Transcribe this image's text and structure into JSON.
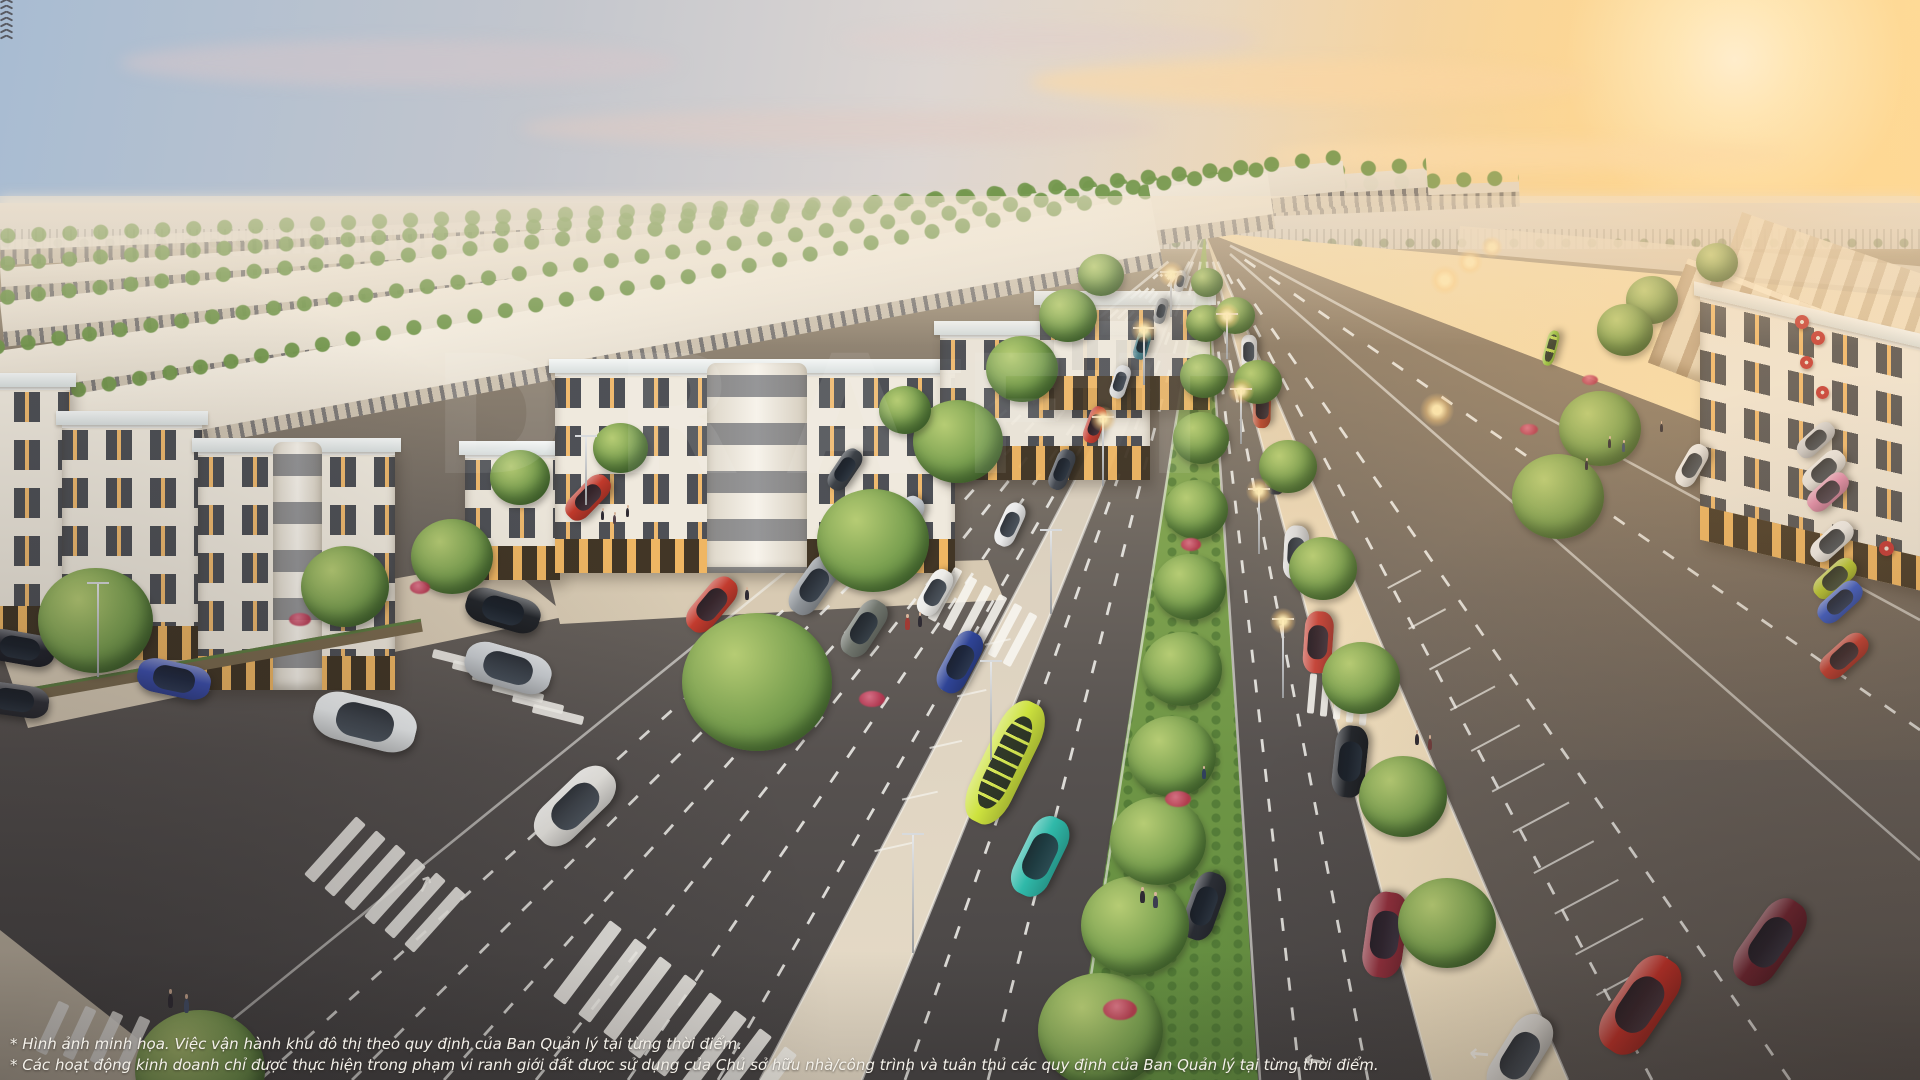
{
  "disclaimer": {
    "line1": "* Hình ảnh minh họa. Việc vận hành khu đô thị theo quy định của Ban Quản lý tại từng thời điểm.",
    "line2": "* Các hoạt động kinh doanh chỉ được thực hiện trong phạm vi ranh giới đất được sử dụng của Chủ sở hữu nhà/công trình và tuân thủ các quy định của Ban Quản lý tại từng thời điểm."
  },
  "watermark": {
    "text": "DRAFT"
  },
  "palette": {
    "sky_cool": "#a8bcd2",
    "sky_warm": "#ffe2a6",
    "sun_core": "#fff8e2",
    "asphalt_dark": "#464343",
    "asphalt_light": "#b3a184",
    "median_grass": "#6f9646",
    "walkway_sand": "#ecd9b8",
    "building_wall": "#efe9dd",
    "roof_slab": "#f2f3f1",
    "window_dark": "#2b2f38",
    "window_lit": "#f0b25c",
    "bus_yellow": "#cde23e",
    "flower_red": "#b8334e",
    "umbrella_red": "#c23434"
  },
  "scene": {
    "vehicles": [
      [
        365,
        722,
        104,
        14,
        "#eceff0",
        "suv"
      ],
      [
        508,
        668,
        88,
        16,
        "#c9cdd1",
        "car"
      ],
      [
        503,
        610,
        76,
        16,
        "#23262b",
        "suv"
      ],
      [
        575,
        806,
        96,
        -44,
        "#e9e7e2",
        "car"
      ],
      [
        174,
        679,
        74,
        12,
        "#3c4fae",
        "car"
      ],
      [
        20,
        648,
        70,
        10,
        "#23252e",
        "car"
      ],
      [
        14,
        700,
        70,
        8,
        "#303138",
        "car"
      ],
      [
        712,
        605,
        64,
        -50,
        "#c23b2e",
        "car"
      ],
      [
        588,
        497,
        54,
        -46,
        "#c0392b",
        "car"
      ],
      [
        864,
        628,
        62,
        -57,
        "#70756d",
        "suv"
      ],
      [
        814,
        585,
        66,
        -55,
        "#8e9398",
        "car"
      ],
      [
        960,
        662,
        66,
        -62,
        "#2f4496",
        "car"
      ],
      [
        1005,
        762,
        132,
        -64,
        "#cde23e",
        "bus"
      ],
      [
        1040,
        856,
        84,
        -64,
        "#2fb9a9",
        "car"
      ],
      [
        935,
        592,
        50,
        -60,
        "#ecebe7",
        "car"
      ],
      [
        905,
        520,
        52,
        -58,
        "#c8cdd2",
        "car"
      ],
      [
        845,
        470,
        46,
        -56,
        "#3d4248",
        "car"
      ],
      [
        1010,
        525,
        46,
        -65,
        "#e8e8e8",
        "car"
      ],
      [
        1062,
        470,
        42,
        -68,
        "#454a52",
        "car"
      ],
      [
        1095,
        425,
        38,
        -70,
        "#c43f33",
        "car"
      ],
      [
        1120,
        382,
        34,
        -72,
        "#d8d8d8",
        "car"
      ],
      [
        1142,
        345,
        30,
        -74,
        "#38727e",
        "car"
      ],
      [
        1161,
        311,
        26,
        -76,
        "#8a8d90",
        "car"
      ],
      [
        1180,
        281,
        22,
        -78,
        "#c0c0c0",
        "car"
      ],
      [
        1385,
        935,
        86,
        -82,
        "#8f2f3c",
        "car"
      ],
      [
        1350,
        762,
        72,
        -84,
        "#23262b",
        "car"
      ],
      [
        1318,
        642,
        62,
        -86,
        "#c4453a",
        "car"
      ],
      [
        1296,
        552,
        54,
        -87,
        "#d9d9d9",
        "car"
      ],
      [
        1276,
        472,
        46,
        -88,
        "#3b3f46",
        "car"
      ],
      [
        1262,
        408,
        40,
        -89,
        "#b4482f",
        "car"
      ],
      [
        1249,
        352,
        34,
        -90,
        "#e0e0e0",
        "car"
      ],
      [
        1551,
        348,
        36,
        -75,
        "#8fc43c",
        "bus"
      ],
      [
        1692,
        466,
        46,
        -60,
        "#e9e9e9",
        "suv"
      ],
      [
        1640,
        1005,
        108,
        -56,
        "#c03028",
        "car"
      ],
      [
        1770,
        942,
        96,
        -55,
        "#6e2430",
        "suv"
      ],
      [
        1520,
        1056,
        90,
        -58,
        "#d8d5cf",
        "car"
      ],
      [
        1816,
        440,
        44,
        -42,
        "#caccd0",
        "car"
      ],
      [
        1824,
        470,
        50,
        -42,
        "#e6e6e6",
        "suv"
      ],
      [
        1828,
        492,
        48,
        -42,
        "#e08bb0",
        "car"
      ],
      [
        1832,
        541,
        50,
        -42,
        "#efefef",
        "car"
      ],
      [
        1835,
        578,
        50,
        -42,
        "#b6c832",
        "car"
      ],
      [
        1840,
        602,
        52,
        -42,
        "#3658c8",
        "car"
      ],
      [
        1844,
        656,
        56,
        -42,
        "#c03a30",
        "car"
      ],
      [
        1204,
        906,
        70,
        -70,
        "#2b2e35",
        "car"
      ]
    ],
    "trees": [
      [
        200,
        1075,
        130
      ],
      [
        95,
        625,
        115
      ],
      [
        345,
        590,
        88
      ],
      [
        452,
        560,
        82
      ],
      [
        520,
        480,
        60
      ],
      [
        757,
        688,
        150
      ],
      [
        873,
        545,
        112
      ],
      [
        958,
        445,
        90
      ],
      [
        1022,
        372,
        72
      ],
      [
        1068,
        318,
        58
      ],
      [
        1101,
        277,
        46
      ],
      [
        1100,
        1035,
        125
      ],
      [
        1135,
        930,
        108
      ],
      [
        1158,
        845,
        96
      ],
      [
        1172,
        760,
        88
      ],
      [
        1182,
        672,
        80
      ],
      [
        1190,
        590,
        72
      ],
      [
        1196,
        512,
        64
      ],
      [
        1201,
        440,
        56
      ],
      [
        1204,
        378,
        48
      ],
      [
        1206,
        325,
        40
      ],
      [
        1207,
        284,
        32
      ],
      [
        1447,
        927,
        98
      ],
      [
        1403,
        800,
        88
      ],
      [
        1361,
        681,
        78
      ],
      [
        1323,
        571,
        68
      ],
      [
        1288,
        469,
        58
      ],
      [
        1258,
        384,
        48
      ],
      [
        1235,
        317,
        40
      ],
      [
        1600,
        432,
        82
      ],
      [
        1558,
        500,
        92
      ],
      [
        1652,
        302,
        52
      ],
      [
        1717,
        264,
        42
      ],
      [
        1625,
        332,
        56
      ],
      [
        620,
        450,
        55
      ],
      [
        905,
        412,
        52
      ]
    ],
    "lights": [
      [
        97,
        677,
        95,
        0
      ],
      [
        585,
        505,
        70,
        0
      ],
      [
        912,
        953,
        120,
        0
      ],
      [
        990,
        760,
        100,
        0
      ],
      [
        1050,
        614,
        85,
        0
      ],
      [
        1102,
        486,
        70,
        1
      ],
      [
        1143,
        385,
        58,
        1
      ],
      [
        1170,
        317,
        46,
        1
      ],
      [
        1282,
        698,
        80,
        1
      ],
      [
        1258,
        554,
        66,
        1
      ],
      [
        1240,
        444,
        56,
        1
      ],
      [
        1226,
        359,
        46,
        1
      ]
    ],
    "glows": [
      [
        1445,
        280,
        30
      ],
      [
        1470,
        262,
        26
      ],
      [
        1492,
        247,
        22
      ],
      [
        1437,
        410,
        34
      ]
    ],
    "pedestrians": [
      [
        168,
        1008,
        14,
        "#2f2b33"
      ],
      [
        184,
        1013,
        14,
        "#46526e"
      ],
      [
        905,
        630,
        12,
        "#a03a34"
      ],
      [
        918,
        627,
        11,
        "#2f2b33"
      ],
      [
        601,
        520,
        9,
        "#2f2b33"
      ],
      [
        613,
        524,
        9,
        "#54424a"
      ],
      [
        626,
        517,
        9,
        "#2f2b33"
      ],
      [
        1140,
        903,
        12,
        "#2f2b33"
      ],
      [
        1153,
        908,
        12,
        "#3c3c50"
      ],
      [
        1415,
        745,
        11,
        "#2f2b33"
      ],
      [
        1428,
        750,
        11,
        "#6e3c3c"
      ],
      [
        1608,
        448,
        9,
        "#2f2b33"
      ],
      [
        1622,
        452,
        9,
        "#3c4c64"
      ],
      [
        1585,
        470,
        9,
        "#2f2b33"
      ],
      [
        1660,
        432,
        8,
        "#2f2b33"
      ],
      [
        1202,
        779,
        10,
        "#30405c"
      ],
      [
        745,
        600,
        10,
        "#2f2b33"
      ]
    ],
    "flowers": [
      [
        872,
        700,
        26
      ],
      [
        1120,
        1010,
        34
      ],
      [
        1178,
        800,
        26
      ],
      [
        1191,
        545,
        20
      ],
      [
        1529,
        430,
        18
      ],
      [
        1590,
        380,
        16
      ],
      [
        300,
        620,
        22
      ],
      [
        420,
        588,
        20
      ]
    ],
    "umbrellas": [
      [
        1802,
        322,
        14
      ],
      [
        1818,
        338,
        14
      ],
      [
        1806,
        362,
        13
      ],
      [
        1822,
        392,
        13
      ],
      [
        1886,
        548,
        15
      ]
    ],
    "birds": [
      [
        1488,
        150
      ],
      [
        1500,
        138
      ],
      [
        1515,
        152
      ],
      [
        1528,
        141
      ],
      [
        1545,
        149
      ],
      [
        1507,
        160
      ],
      [
        1478,
        143
      ]
    ],
    "zebras": [
      {
        "x": 540,
        "y": 955,
        "rot": -53,
        "n": 8,
        "len": 95,
        "w": 15,
        "dx": 25,
        "dy": 18
      },
      {
        "x": 916,
        "y": 590,
        "rot": -62,
        "n": 6,
        "len": 58,
        "w": 9,
        "dx": 15,
        "dy": 9
      },
      {
        "x": 25,
        "y": 1022,
        "rot": -65,
        "n": 5,
        "len": 55,
        "w": 12,
        "dx": 27,
        "dy": 5
      },
      {
        "x": 432,
        "y": 655,
        "rot": 14,
        "n": 6,
        "len": 52,
        "w": 9,
        "dx": 20,
        "dy": 11
      },
      {
        "x": 296,
        "y": 843,
        "rot": -48,
        "n": 6,
        "len": 78,
        "w": 13,
        "dx": 20,
        "dy": 14
      },
      {
        "x": 1292,
        "y": 690,
        "rot": -85,
        "n": 5,
        "len": 40,
        "w": 7,
        "dx": 13,
        "dy": 3
      }
    ],
    "arrows": [
      [
        1305,
        1048,
        -80,
        26
      ],
      [
        1470,
        1042,
        -85,
        24
      ],
      [
        415,
        875,
        25,
        22
      ]
    ],
    "markings": {
      "vp": [
        1205,
        232
      ],
      "solid": [
        [
          158,
          1080
        ],
        [
          760,
          1080
        ],
        [
          862,
          1080
        ],
        [
          1075,
          1080
        ],
        [
          1260,
          1080
        ],
        [
          1432,
          1080
        ],
        [
          1568,
          1080
        ],
        [
          1920,
          620
        ],
        [
          1920,
          860
        ]
      ],
      "dashed": [
        [
          260,
          1080
        ],
        [
          352,
          1080
        ],
        [
          444,
          1080
        ],
        [
          536,
          1080
        ],
        [
          628,
          1080
        ],
        [
          718,
          1080
        ],
        [
          905,
          1080
        ],
        [
          988,
          1080
        ],
        [
          1300,
          1080
        ],
        [
          1368,
          1080
        ],
        [
          1652,
          1080
        ],
        [
          1790,
          1080
        ],
        [
          1920,
          730
        ]
      ],
      "stalls_right": {
        "bx": 1640,
        "by": 1080,
        "t0": 0.1,
        "t1": 0.6,
        "step": 0.048,
        "ux": 0.88,
        "uy": -0.47,
        "len": 90
      },
      "stalls_main": {
        "bx": 800,
        "by": 1080,
        "t0": 0.28,
        "t1": 0.54,
        "step": 0.06,
        "ux": -0.9,
        "uy": 0.2,
        "len": 60
      }
    }
  }
}
